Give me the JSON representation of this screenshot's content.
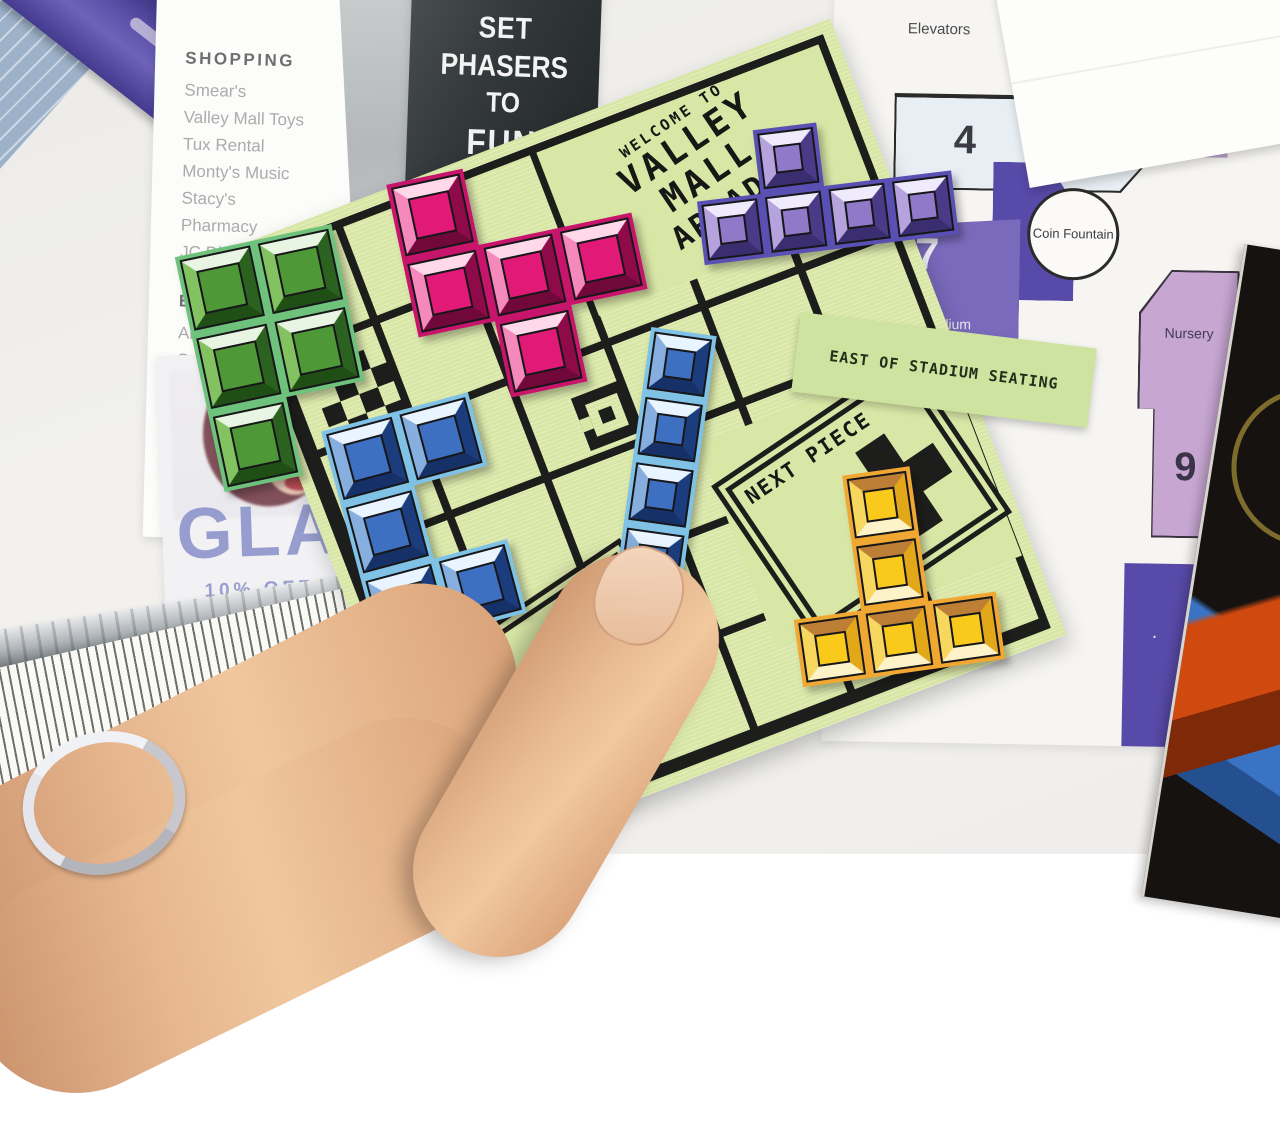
{
  "colors": {
    "background": "#f0efec",
    "board-green": "#d9e7a6",
    "grid-black": "#1d1d1b",
    "slip-green": "#cfe3a0",
    "poster-dark": "#2e3234",
    "map-light-blue": "#e7eef4",
    "map-light-purple": "#c7a6d2",
    "map-mid-purple": "#7a6abc",
    "map-dark-purple": "#584aa8",
    "piece-blue-face": "#3e70c2",
    "piece-green-face": "#4f9838",
    "piece-pink-face": "#e01a76",
    "piece-purple-face": "#9079c9",
    "piece-yellow-face": "#f9ca1b"
  },
  "directory": {
    "shopping_title": "SHOPPING",
    "shopping_items": [
      "Smear's",
      "Valley Mall Toys",
      "Tux Rental",
      "Monty's Music",
      "Stacy's",
      "Pharmacy",
      "JC Dimes"
    ],
    "entertainment_title": "ENTERTAINMENT",
    "entertainment_items": [
      "Arcade",
      "Stadium seating",
      "Multiplex"
    ],
    "dining_title": "DINING",
    "dining_items": [
      "Foo",
      "Sco"
    ]
  },
  "poster": {
    "line1": "SET",
    "line2": "PHASERS",
    "line3": "TO",
    "line4": "FUN"
  },
  "board": {
    "welcome_small": "WELCOME TO",
    "welcome_line1": "VALLEY",
    "welcome_line2": "MALL",
    "welcome_line3": "ARCADE",
    "next_piece_label": "NEXT PIECE",
    "free_label": "FREE"
  },
  "slip": {
    "text": "EAST OF STADIUM SEATING"
  },
  "map": {
    "elevators_label": "Elevators",
    "zone3": "3",
    "zone4": "4",
    "valley_mall_toys_label": "Valley Mall Toys",
    "zone5": "5",
    "coin_fountain_label": "Coin Fountain",
    "zone7": "7",
    "stadium_seating_line1": "Stadium",
    "stadium_seating_line2": "seating",
    "nursery_label": "Nursery",
    "zone9": "9"
  },
  "glam": {
    "title": "GLAM",
    "offer": "10% OFF WITH"
  },
  "pieces": [
    {
      "name": "green-p-pentomino",
      "color": "green",
      "block": 80,
      "cells": [
        [
          0,
          0
        ],
        [
          1,
          0
        ],
        [
          0,
          1
        ],
        [
          1,
          1
        ],
        [
          0,
          2
        ]
      ],
      "x": 198,
      "y": 238,
      "rot": -12
    },
    {
      "name": "pink-f-pentomino",
      "color": "pink",
      "block": 78,
      "cells": [
        [
          0,
          0
        ],
        [
          0,
          1
        ],
        [
          1,
          1
        ],
        [
          2,
          1
        ],
        [
          1,
          2
        ]
      ],
      "x": 408,
      "y": 158,
      "rot": -12
    },
    {
      "name": "purple-y-pentomino",
      "color": "purple",
      "block": 64,
      "cells": [
        [
          1,
          0
        ],
        [
          0,
          1
        ],
        [
          1,
          1
        ],
        [
          2,
          1
        ],
        [
          3,
          1
        ]
      ],
      "x": 696,
      "y": 122,
      "rot": -7
    },
    {
      "name": "blue-u-pentomino",
      "color": "blue",
      "block": 76,
      "cells": [
        [
          0,
          0
        ],
        [
          1,
          0
        ],
        [
          0,
          1
        ],
        [
          0,
          2
        ],
        [
          1,
          2
        ]
      ],
      "x": 348,
      "y": 408,
      "rot": -15
    },
    {
      "name": "yellow-t-pentomino",
      "color": "yellow",
      "block": 68,
      "cells": [
        [
          1,
          0
        ],
        [
          1,
          1
        ],
        [
          0,
          2
        ],
        [
          1,
          2
        ],
        [
          2,
          2
        ]
      ],
      "x": 788,
      "y": 470,
      "rot": -8
    },
    {
      "name": "pink-domino",
      "color": "pink",
      "block": 88,
      "cells": [
        [
          0,
          0
        ],
        [
          1,
          0
        ]
      ],
      "x": 372,
      "y": 692,
      "rot": -12
    },
    {
      "name": "blue-i-pentomino",
      "color": "blue",
      "block": 66,
      "cells": [
        [
          0,
          0
        ],
        [
          0,
          1
        ],
        [
          0,
          2
        ],
        [
          0,
          3
        ],
        [
          0,
          4
        ]
      ],
      "x": 628,
      "y": 330,
      "rot": 8
    }
  ]
}
